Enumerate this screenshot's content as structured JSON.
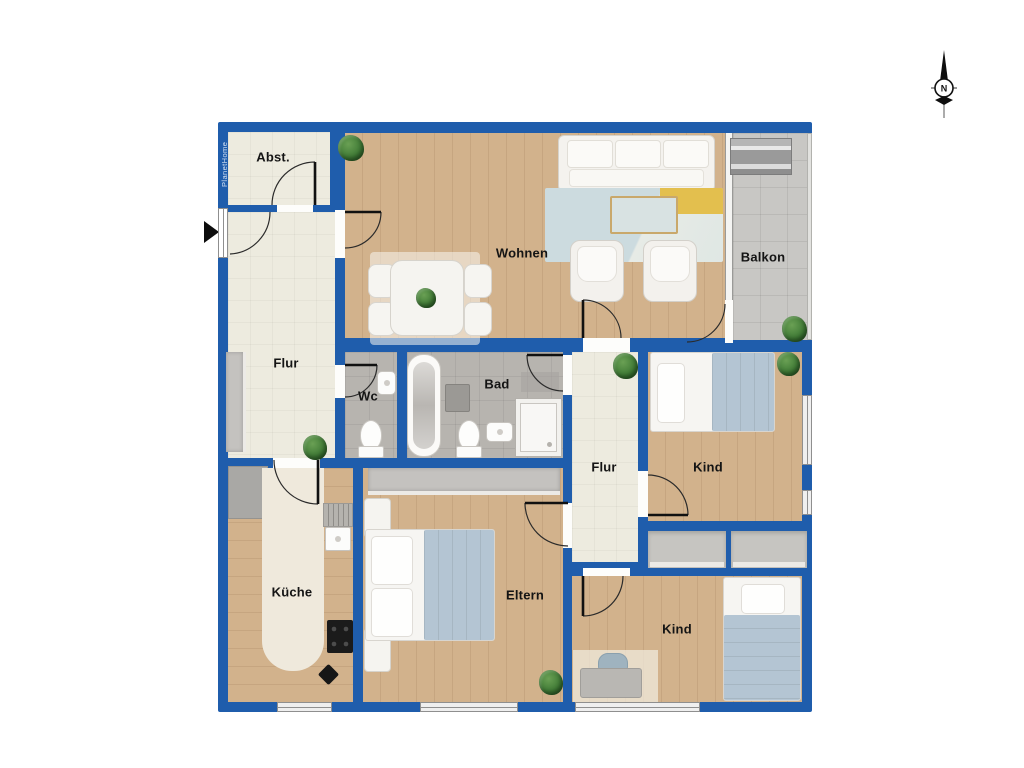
{
  "plan": {
    "watermark": "PlanetHome",
    "compass": {
      "label": "N"
    },
    "rooms": [
      {
        "name": "abstellraum",
        "label": "Abst."
      },
      {
        "name": "wohnen",
        "label": "Wohnen"
      },
      {
        "name": "balkon",
        "label": "Balkon"
      },
      {
        "name": "flur",
        "label": "Flur"
      },
      {
        "name": "wc",
        "label": "Wc"
      },
      {
        "name": "bad",
        "label": "Bad"
      },
      {
        "name": "flur-2",
        "label": "Flur"
      },
      {
        "name": "kind-1",
        "label": "Kind"
      },
      {
        "name": "kueche",
        "label": "Küche"
      },
      {
        "name": "eltern",
        "label": "Eltern"
      },
      {
        "name": "kind-2",
        "label": "Kind"
      }
    ],
    "colors": {
      "wall": "#1f5dac",
      "wood": "#d2b28c",
      "tile_light": "#edebdf",
      "tile_gray": "#b7b4af",
      "balcony": "#c8c7c4",
      "closet": "#c6c5c1",
      "accent_blanket": "#b4c5d3",
      "rug_blue": "#ccdbdf",
      "rug_yellow": "#e3bf4e",
      "plant": "#3c7733"
    }
  }
}
